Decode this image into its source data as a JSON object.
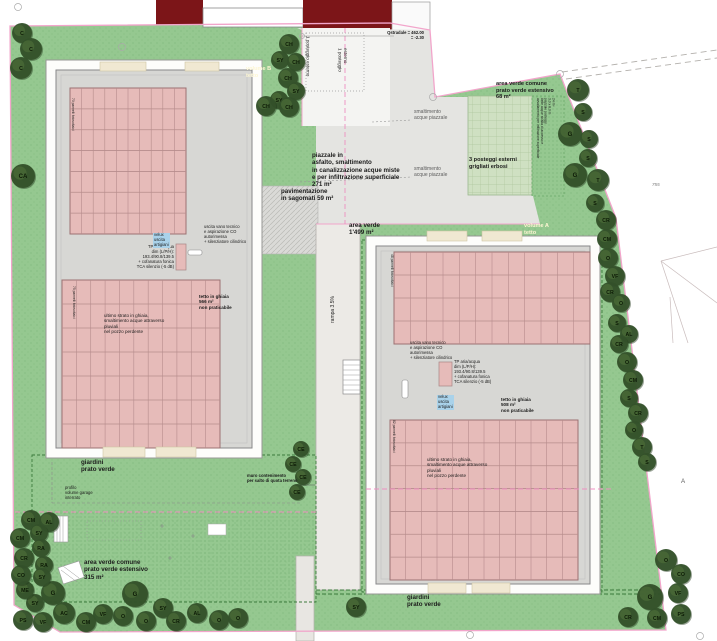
{
  "colors": {
    "lawn": "#95c890",
    "lawnDot": "#6aa868",
    "grigliato": "#cfe0c2",
    "asphalt": "#e4e4e1",
    "paving": "#dadad7",
    "ramp": "#eceae6",
    "roof": "#d7d7d4",
    "frame": "#fdfdfb",
    "panel": "#e6bbb9",
    "panelLine": "#b68c8c",
    "panelEdge": "#9c7272",
    "red": "#7c1518",
    "pink": "#f2a5cb",
    "pinkDash": "#ee8fc0",
    "hedge": "#3c7a3c",
    "treeDark": "#34512a",
    "treeLight": "#4c6c38"
  },
  "labels": {
    "volume_b": "volume B\ntetto",
    "volume_a": "volume A\ntetto",
    "posteggio_1": "1 posteggio esterno",
    "posteggio_2": "1 posteggio\nesterno",
    "quota": "Qstradale = 462.00\n= -2.30",
    "smaltimento": "smaltimento\nacque piazzale",
    "area_verde_68": "area verde comune\nprato verde estensivo\n68 m²",
    "posteggi_3": "3 posteggi esterni\ngrigliati erbosi",
    "piazzale": "piazzale in\nasfalto, smaltimento\nin canalizzazione acque miste\ne per infiltrazione superficiale\n271 m²",
    "pavimentazione": "pavimentazione\nin sagomati 59 m²",
    "area_verde_1499": "area verde\n1'499 m²",
    "rampa": "rampa 3.5%",
    "avvallamento": "avvallamento per infiltrazione superficiale\ndelle acque strada di accesso e\npiazzale posteggi\n3.0 x 8.0 m\n24 m²",
    "uscita_vano": "uscita vano tecnico\ne aspirazione CO\nautorimessa\n+ silenziatore cilindrico",
    "tp_unit": "TP aria/acqua\ndim (L/P/H):\n193.4/90.8/139.5\n+ cofanatura fonica\nTCA silenzio (-5 dB)",
    "velux": "velux\nuscita\nartigiani",
    "tetto_b": "tetto in ghiaia\n566 m²\nnon praticabile",
    "tetto_a": "tetto in ghiaia\n508 m²\nnon praticabile",
    "ultimo_strato": "ultimo strato in ghiaia,\nsmaltimento acque attraverso\npluviali\nnel pozzo perdente",
    "pannelli_70": "70 pannelli fotovoltaici",
    "pannelli_75": "75 pannelli fotovoltaici",
    "pannelli_48": "48 pannelli fotovoltaici",
    "pannelli_82": "82 pannelli fotovoltaici",
    "giardini": "giardini\nprato verde",
    "profilo_garage": "profilo\nvolume garage\ninterrato",
    "muro": "muro contenimento\nper salto di quota terreno",
    "area_verde_315": "area verde comune\nprato verde estensivo\n315 m²",
    "parcel_755": "755",
    "section_a": "A"
  },
  "panel_arrays": [
    {
      "x": 70,
      "y": 88,
      "w": 116,
      "h": 146,
      "cols": 10,
      "rows": 7
    },
    {
      "x": 62,
      "y": 280,
      "w": 158,
      "h": 168,
      "cols": 11,
      "rows": 7
    },
    {
      "x": 394,
      "y": 252,
      "w": 196,
      "h": 92,
      "cols": 12,
      "rows": 4
    },
    {
      "x": 390,
      "y": 420,
      "w": 188,
      "h": 160,
      "cols": 12,
      "rows": 7
    }
  ],
  "trees": [
    [
      22,
      33,
      10,
      "C"
    ],
    [
      31,
      49,
      11,
      "C"
    ],
    [
      21,
      68,
      11,
      "C"
    ],
    [
      23,
      176,
      12,
      "CA"
    ],
    [
      289,
      44,
      10,
      "CH"
    ],
    [
      280,
      60,
      9,
      "SY"
    ],
    [
      296,
      62,
      9,
      "CH"
    ],
    [
      288,
      78,
      10,
      "CH"
    ],
    [
      296,
      91,
      9,
      "SY"
    ],
    [
      279,
      100,
      9,
      "SY"
    ],
    [
      266,
      106,
      10,
      "CH"
    ],
    [
      289,
      107,
      10,
      "CH"
    ],
    [
      578,
      90,
      11,
      "T"
    ],
    [
      583,
      112,
      9,
      "S"
    ],
    [
      570,
      134,
      12,
      "G"
    ],
    [
      589,
      139,
      9,
      "S"
    ],
    [
      588,
      158,
      9,
      "S"
    ],
    [
      575,
      175,
      12,
      "G"
    ],
    [
      598,
      180,
      11,
      "T"
    ],
    [
      595,
      203,
      9,
      "S"
    ],
    [
      606,
      220,
      10,
      "CR"
    ],
    [
      607,
      239,
      10,
      "CM"
    ],
    [
      608,
      258,
      10,
      "O"
    ],
    [
      615,
      276,
      10,
      "VF"
    ],
    [
      610,
      292,
      10,
      "CR"
    ],
    [
      621,
      303,
      9,
      "O"
    ],
    [
      617,
      323,
      9,
      "S"
    ],
    [
      629,
      334,
      9,
      "AL"
    ],
    [
      619,
      344,
      9,
      "CR"
    ],
    [
      627,
      362,
      10,
      "O"
    ],
    [
      633,
      380,
      10,
      "CM"
    ],
    [
      629,
      398,
      9,
      "S"
    ],
    [
      638,
      413,
      10,
      "CR"
    ],
    [
      634,
      430,
      9,
      "O"
    ],
    [
      642,
      447,
      10,
      "T"
    ],
    [
      647,
      462,
      9,
      "S"
    ],
    [
      666,
      560,
      11,
      "O"
    ],
    [
      681,
      574,
      10,
      "CO"
    ],
    [
      678,
      593,
      10,
      "VF"
    ],
    [
      650,
      597,
      13,
      "G"
    ],
    [
      681,
      614,
      10,
      "PS"
    ],
    [
      628,
      617,
      10,
      "CR"
    ],
    [
      657,
      618,
      10,
      "CM"
    ],
    [
      356,
      607,
      10,
      "SY"
    ],
    [
      23,
      620,
      10,
      "PS"
    ],
    [
      43,
      622,
      10,
      "VF"
    ],
    [
      35,
      603,
      9,
      "SY"
    ],
    [
      25,
      590,
      9,
      "ME"
    ],
    [
      53,
      593,
      12,
      "G"
    ],
    [
      64,
      613,
      11,
      "AC"
    ],
    [
      86,
      622,
      10,
      "CM"
    ],
    [
      103,
      614,
      10,
      "VF"
    ],
    [
      123,
      616,
      10,
      "O"
    ],
    [
      135,
      594,
      13,
      "G"
    ],
    [
      146,
      621,
      10,
      "O"
    ],
    [
      163,
      608,
      10,
      "SY"
    ],
    [
      176,
      621,
      10,
      "CR"
    ],
    [
      197,
      613,
      10,
      "AL"
    ],
    [
      219,
      620,
      10,
      "O"
    ],
    [
      238,
      618,
      10,
      "O"
    ],
    [
      31,
      520,
      10,
      "CM"
    ],
    [
      49,
      522,
      10,
      "AL"
    ],
    [
      20,
      538,
      10,
      "CM"
    ],
    [
      39,
      533,
      9,
      "SY"
    ],
    [
      41,
      548,
      9,
      "RA"
    ],
    [
      24,
      558,
      10,
      "CR"
    ],
    [
      44,
      565,
      9,
      "RA"
    ],
    [
      21,
      575,
      10,
      "CO"
    ],
    [
      42,
      577,
      9,
      "SY"
    ],
    [
      301,
      449,
      8,
      "CE"
    ],
    [
      293,
      464,
      8,
      "CE"
    ],
    [
      303,
      477,
      8,
      "CE"
    ],
    [
      297,
      492,
      8,
      "CE"
    ]
  ]
}
